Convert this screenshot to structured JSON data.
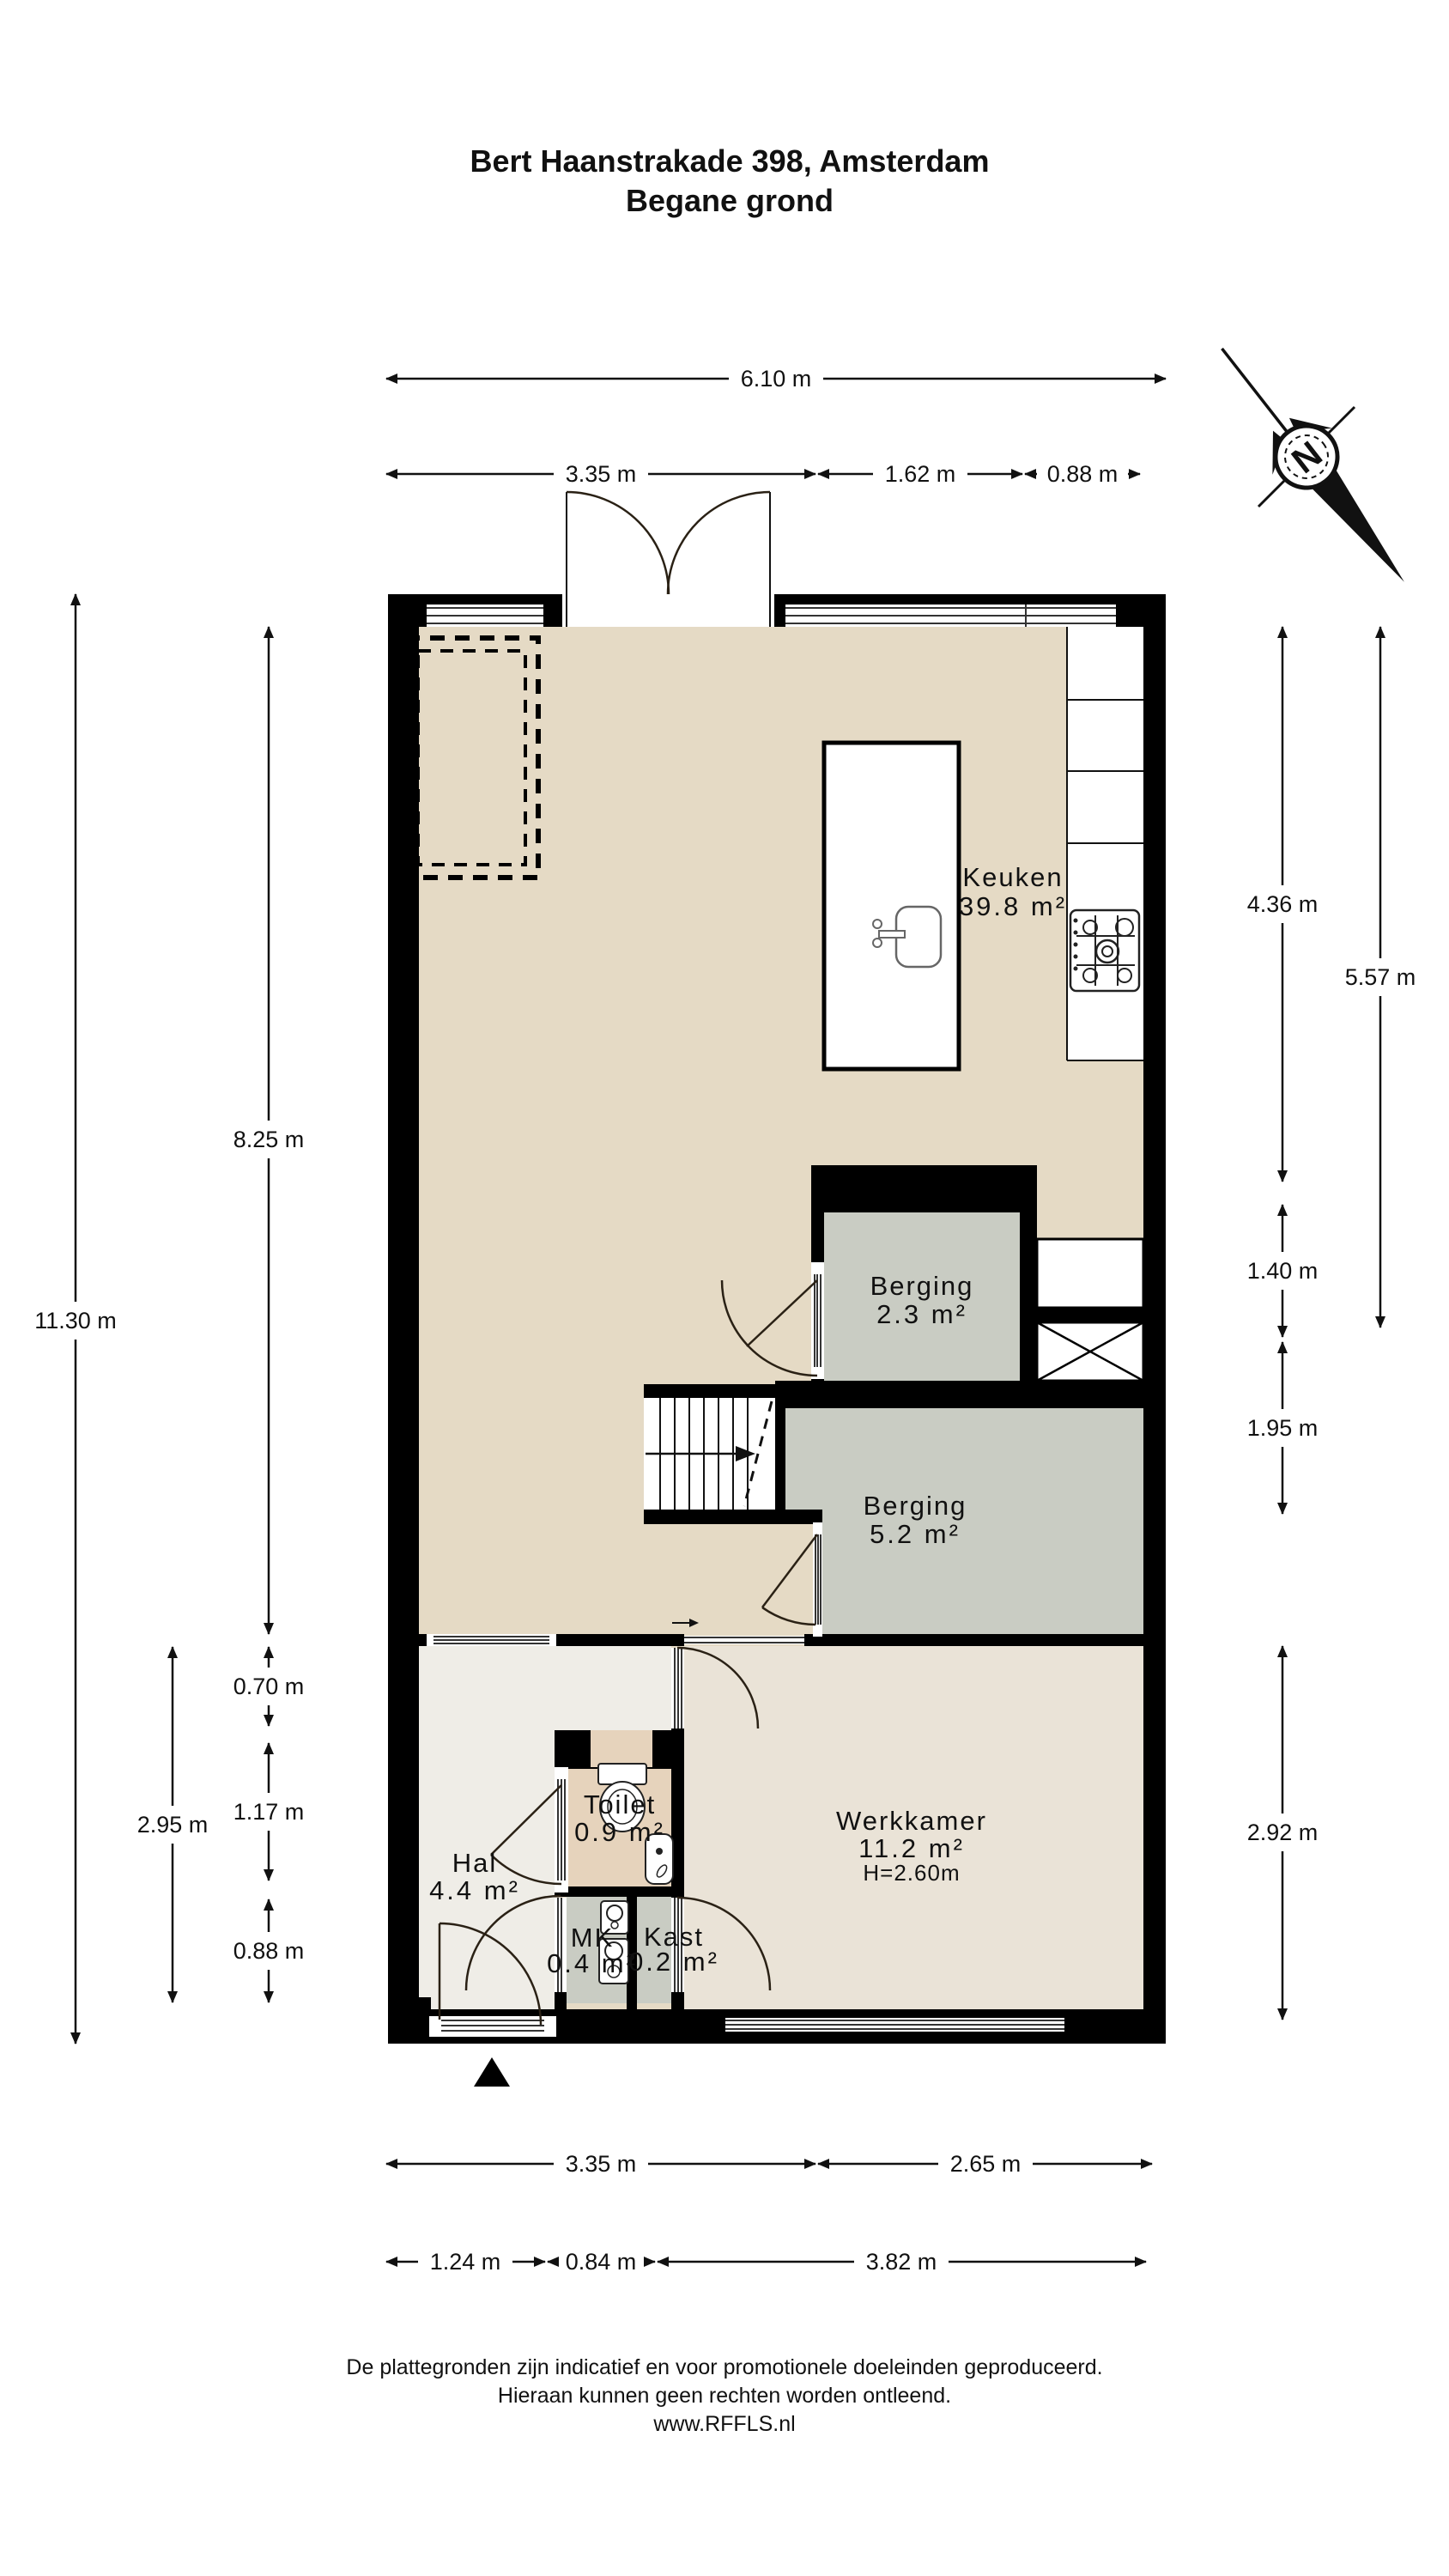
{
  "title": {
    "line1": "Bert Haanstrakade 398, Amsterdam",
    "line2": "Begane grond"
  },
  "compass": {
    "north_label": "N"
  },
  "rooms": {
    "keuken": {
      "name": "Keuken",
      "area": "39.8 m²"
    },
    "berging_small": {
      "name": "Berging",
      "area": "2.3 m²"
    },
    "berging_large": {
      "name": "Berging",
      "area": "5.2 m²"
    },
    "werkkamer": {
      "name": "Werkkamer",
      "area": "11.2 m²",
      "ceiling_height": "H=2.60m"
    },
    "hal": {
      "name": "Hal",
      "area": "4.4 m²"
    },
    "toilet": {
      "name": "Toilet",
      "area": "0.9 m²"
    },
    "mk": {
      "name": "MK",
      "area": "0.4 m²"
    },
    "kast": {
      "name": "Kast",
      "area": "0.2 m²"
    }
  },
  "dimensions": {
    "top_total": "6.10 m",
    "top_segments": [
      "3.35 m",
      "1.62 m",
      "0.88 m"
    ],
    "left_total": "11.30 m",
    "left_inner": [
      "8.25 m",
      "0.70 m",
      "1.17 m",
      "0.88 m"
    ],
    "left_lower_total": "2.95 m",
    "right_outer": [
      "4.36 m",
      "5.57 m"
    ],
    "right_inner": [
      "1.40 m",
      "1.95 m",
      "2.92 m"
    ],
    "bottom_row1": [
      "3.35 m",
      "2.65 m"
    ],
    "bottom_row2": [
      "1.24 m",
      "0.84 m",
      "3.82 m"
    ]
  },
  "footer": {
    "line1": "De plattegronden zijn indicatief en voor promotionele doeleinden geproduceerd.",
    "line2": "Hieraan kunnen geen rechten worden ontleend.",
    "line3": "www.RFFLS.nl"
  },
  "colors": {
    "wall": "#000000",
    "floor_main": "#e5dac5",
    "floor_werkkamer": "#eae3d7",
    "floor_hal": "#efede7",
    "floor_toilet": "#e6d3bc",
    "floor_storage": "#c9ccc3"
  }
}
